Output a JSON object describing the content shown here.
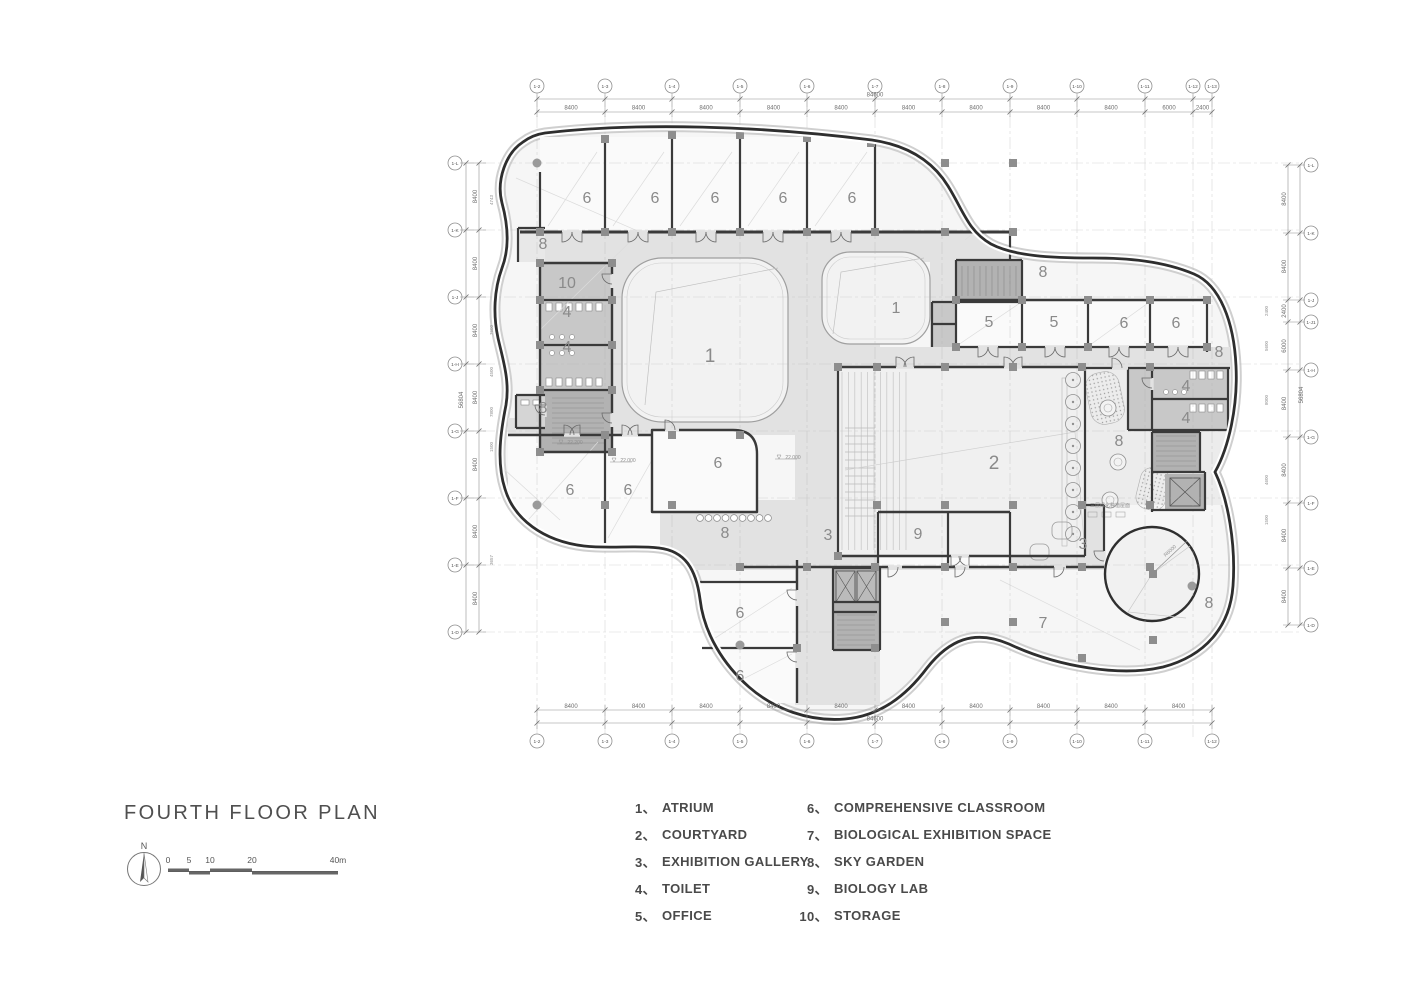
{
  "title": "FOURTH FLOOR PLAN",
  "north": {
    "label": "N"
  },
  "scalebar": {
    "ticks": [
      "0",
      "5",
      "10",
      "20",
      "40m"
    ]
  },
  "legend": {
    "col1": [
      {
        "num": "1、",
        "label": "ATRIUM"
      },
      {
        "num": "2、",
        "label": "COURTYARD"
      },
      {
        "num": "3、",
        "label": "EXHIBITION GALLERY"
      },
      {
        "num": "4、",
        "label": "TOILET"
      },
      {
        "num": "5、",
        "label": "OFFICE"
      }
    ],
    "col2": [
      {
        "num": "6、",
        "label": "COMPREHENSIVE CLASSROOM"
      },
      {
        "num": "7、",
        "label": "BIOLOGICAL EXHIBITION SPACE"
      },
      {
        "num": "8、",
        "label": "SKY GARDEN"
      },
      {
        "num": "9、",
        "label": "BIOLOGY LAB"
      },
      {
        "num": "10、",
        "label": "STORAGE"
      }
    ]
  },
  "plan": {
    "room_labels": [
      {
        "t": "6",
        "x": 587,
        "y": 198
      },
      {
        "t": "6",
        "x": 655,
        "y": 198
      },
      {
        "t": "6",
        "x": 715,
        "y": 198
      },
      {
        "t": "6",
        "x": 783,
        "y": 198
      },
      {
        "t": "6",
        "x": 852,
        "y": 198
      },
      {
        "t": "8",
        "x": 543,
        "y": 244
      },
      {
        "t": "10",
        "x": 567,
        "y": 283
      },
      {
        "t": "4",
        "x": 567,
        "y": 312
      },
      {
        "t": "4",
        "x": 567,
        "y": 347
      },
      {
        "t": "1",
        "x": 710,
        "y": 357,
        "s": 19
      },
      {
        "t": "1",
        "x": 896,
        "y": 308
      },
      {
        "t": "8",
        "x": 1043,
        "y": 272
      },
      {
        "t": "5",
        "x": 989,
        "y": 322
      },
      {
        "t": "5",
        "x": 1054,
        "y": 322
      },
      {
        "t": "6",
        "x": 1124,
        "y": 323
      },
      {
        "t": "6",
        "x": 1176,
        "y": 323
      },
      {
        "t": "8",
        "x": 1219,
        "y": 352
      },
      {
        "t": "4",
        "x": 1186,
        "y": 386
      },
      {
        "t": "4",
        "x": 1186,
        "y": 418
      },
      {
        "t": "2",
        "x": 994,
        "y": 464,
        "s": 19
      },
      {
        "t": "8",
        "x": 1119,
        "y": 441
      },
      {
        "t": "8",
        "x": 543,
        "y": 408
      },
      {
        "t": "6",
        "x": 570,
        "y": 490
      },
      {
        "t": "6",
        "x": 628,
        "y": 490
      },
      {
        "t": "6",
        "x": 718,
        "y": 463
      },
      {
        "t": "8",
        "x": 725,
        "y": 533
      },
      {
        "t": "3",
        "x": 828,
        "y": 535
      },
      {
        "t": "9",
        "x": 918,
        "y": 534
      },
      {
        "t": "3",
        "x": 1083,
        "y": 544
      },
      {
        "t": "7",
        "x": 1043,
        "y": 623
      },
      {
        "t": "6",
        "x": 740,
        "y": 613
      },
      {
        "t": "6",
        "x": 740,
        "y": 676
      },
      {
        "t": "8",
        "x": 1209,
        "y": 603
      }
    ],
    "annotations": [
      {
        "t": "22.200",
        "x": 575,
        "y": 444,
        "lvl": true
      },
      {
        "t": "22.000",
        "x": 628,
        "y": 462,
        "lvl": true
      },
      {
        "t": "22.000",
        "x": 793,
        "y": 459,
        "lvl": true
      },
      {
        "t": "R6000",
        "x": 1171,
        "y": 552,
        "rot": -42
      },
      {
        "t": "三层绿化种植屋面",
        "x": 1110,
        "y": 507
      }
    ],
    "grid": {
      "top": {
        "bubbles": [
          {
            "l": "1-2",
            "x": 537
          },
          {
            "l": "1-3",
            "x": 605
          },
          {
            "l": "1-4",
            "x": 672
          },
          {
            "l": "1-5",
            "x": 740
          },
          {
            "l": "1-6",
            "x": 807
          },
          {
            "l": "1-7",
            "x": 875
          },
          {
            "l": "1-8",
            "x": 942
          },
          {
            "l": "1-9",
            "x": 1010
          },
          {
            "l": "1-10",
            "x": 1077
          },
          {
            "l": "1-11",
            "x": 1145
          },
          {
            "l": "1-12",
            "x": 1193
          },
          {
            "l": "1-13",
            "x": 1212
          }
        ]
      },
      "bottom": {
        "bubbles": [
          {
            "l": "1-2",
            "x": 537
          },
          {
            "l": "1-3",
            "x": 605
          },
          {
            "l": "1-4",
            "x": 672
          },
          {
            "l": "1-5",
            "x": 740
          },
          {
            "l": "1-6",
            "x": 807
          },
          {
            "l": "1-7",
            "x": 875
          },
          {
            "l": "1-8",
            "x": 942
          },
          {
            "l": "1-9",
            "x": 1010
          },
          {
            "l": "1-10",
            "x": 1077
          },
          {
            "l": "1-11",
            "x": 1145
          },
          {
            "l": "1-12",
            "x": 1212
          }
        ]
      },
      "left": {
        "bubbles": [
          {
            "l": "1-L",
            "y": 163
          },
          {
            "l": "1-K",
            "y": 230
          },
          {
            "l": "1-J",
            "y": 297
          },
          {
            "l": "1-H",
            "y": 364
          },
          {
            "l": "1-G",
            "y": 431
          },
          {
            "l": "1-F",
            "y": 498
          },
          {
            "l": "1-E",
            "y": 565
          },
          {
            "l": "1-D",
            "y": 632
          }
        ]
      },
      "right": {
        "bubbles": [
          {
            "l": "1-L",
            "y": 165
          },
          {
            "l": "1-K",
            "y": 233
          },
          {
            "l": "1-J",
            "y": 300
          },
          {
            "l": "1-J1",
            "y": 322
          },
          {
            "l": "1-H",
            "y": 370
          },
          {
            "l": "1-G",
            "y": 437
          },
          {
            "l": "1-F",
            "y": 503
          },
          {
            "l": "1-E",
            "y": 568
          },
          {
            "l": "1-D",
            "y": 625
          }
        ]
      }
    },
    "dims": {
      "top": {
        "segs": [
          "8400",
          "8400",
          "8400",
          "8400",
          "8400",
          "8400",
          "8400",
          "8400",
          "8400",
          "6000",
          "2400"
        ],
        "total": "84600"
      },
      "bottom": {
        "segs": [
          "8400",
          "8400",
          "8400",
          "8400",
          "8400",
          "8400",
          "8400",
          "8400",
          "8400",
          "8400"
        ],
        "total": "84600"
      },
      "left": {
        "segs": [
          "8400",
          "8400",
          "8400",
          "8400",
          "8400",
          "8400",
          "8400"
        ],
        "total": "56804",
        "sub": [
          {
            "t": "4743",
            "y": 200
          },
          {
            "t": "7600",
            "y": 330
          },
          {
            "t": "4500",
            "y": 372
          },
          {
            "t": "7800",
            "y": 412
          },
          {
            "t": "1500",
            "y": 447
          },
          {
            "t": "3657",
            "y": 560
          }
        ]
      },
      "right": {
        "segs": [
          "8400",
          "8400",
          "2400",
          "6000",
          "8400",
          "8400",
          "8400",
          "8400"
        ],
        "total": "56804",
        "sub": [
          {
            "t": "2400",
            "y": 311
          },
          {
            "t": "5600",
            "y": 346
          },
          {
            "t": "8000",
            "y": 400
          },
          {
            "t": "4600",
            "y": 480
          },
          {
            "t": "1500",
            "y": 520
          }
        ]
      }
    }
  }
}
